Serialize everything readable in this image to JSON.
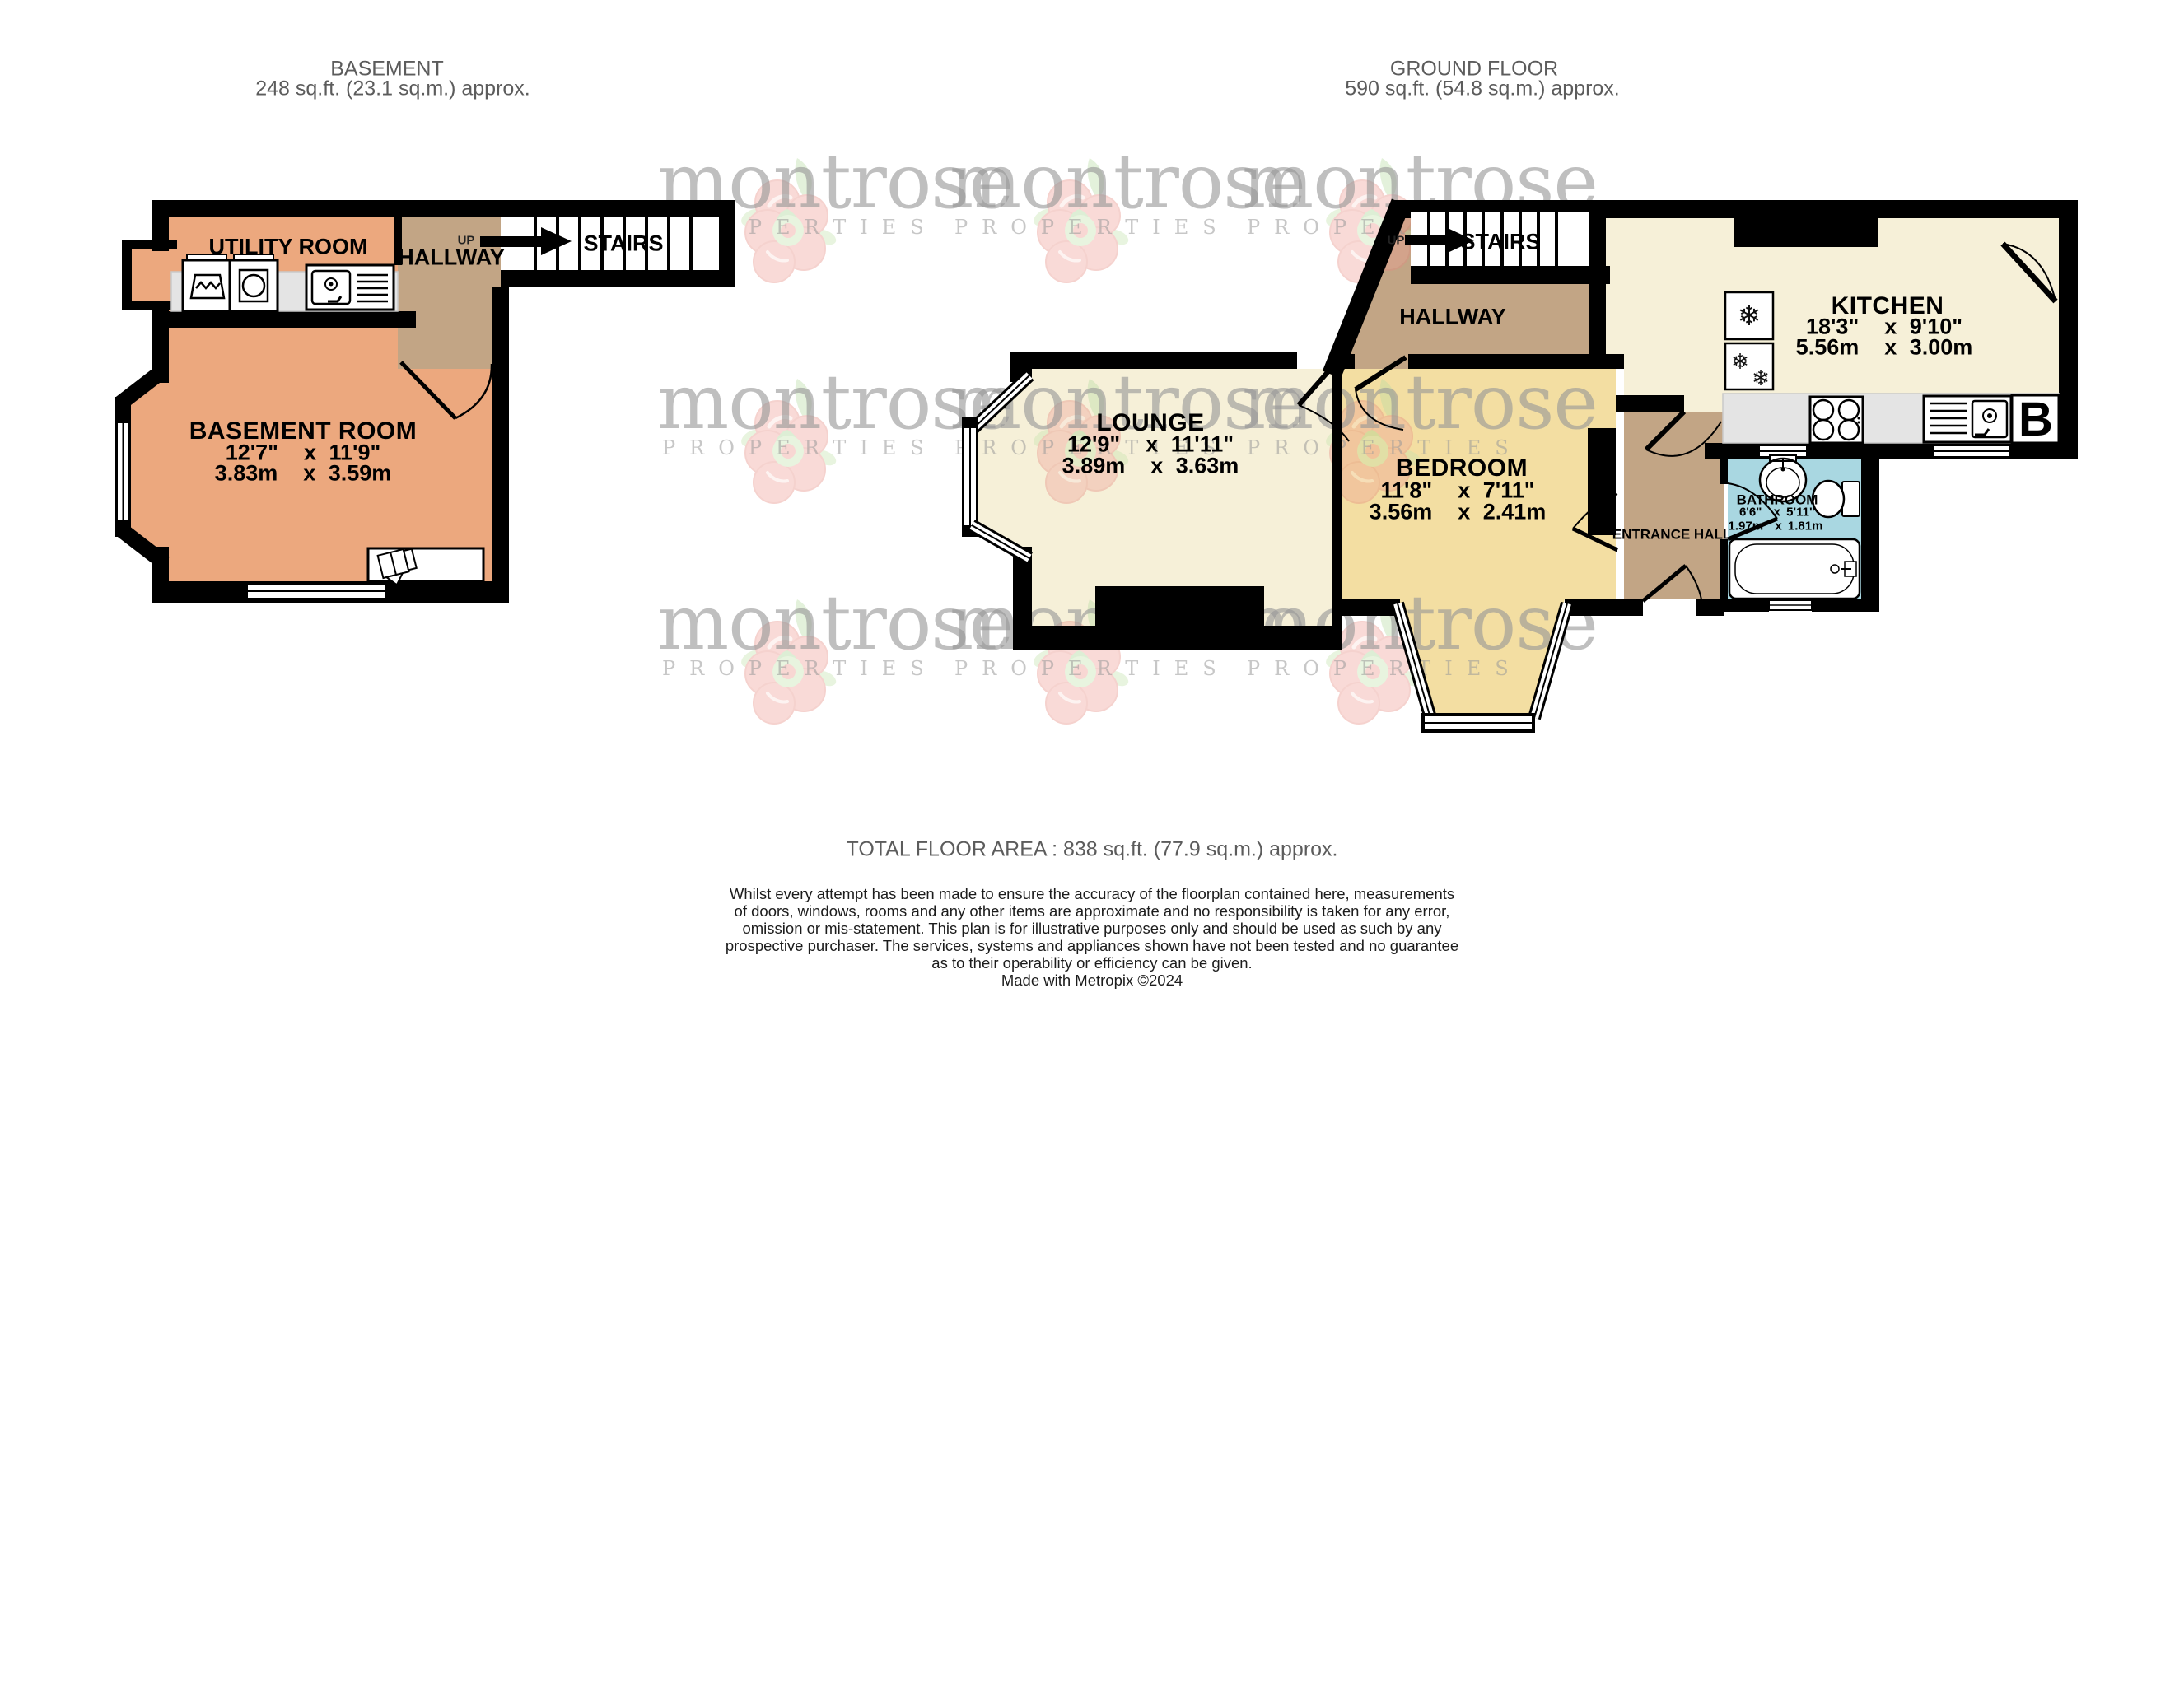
{
  "watermark": {
    "name": "montrose",
    "sub": "PROPERTIES"
  },
  "icons": {
    "snowflake": "❄"
  },
  "plans": {
    "basement": {
      "title": "BASEMENT",
      "area": "248 sq.ft. (23.1 sq.m.) approx.",
      "rooms": {
        "utility": {
          "name": "UTILITY ROOM"
        },
        "hallway": {
          "name": "HALLWAY",
          "up": "UP"
        },
        "stairs": {
          "name": "STAIRS"
        },
        "basement_room": {
          "name": "BASEMENT ROOM",
          "imperial": "12'7\"  x 11'9\"",
          "metric": "3.83m  x 3.59m"
        }
      }
    },
    "ground": {
      "title": "GROUND FLOOR",
      "area": "590 sq.ft. (54.8 sq.m.) approx.",
      "rooms": {
        "stairs": {
          "name": "STAIRS",
          "up": "UP"
        },
        "hallway": {
          "name": "HALLWAY"
        },
        "kitchen": {
          "name": "KITCHEN",
          "imperial": "18'3\"  x 9'10\"",
          "metric": "5.56m  x 3.00m"
        },
        "lounge": {
          "name": "LOUNGE",
          "imperial": "12'9\"  x 11'11\"",
          "metric": "3.89m  x 3.63m"
        },
        "bedroom": {
          "name": "BEDROOM",
          "imperial": "11'8\"  x 7'11\"",
          "metric": "3.56m  x 2.41m"
        },
        "entrance": {
          "name": "ENTRANCE HALL"
        },
        "bathroom": {
          "name": "BATHROOM",
          "imperial": "6'6\"  x 5'11\"",
          "metric": "1.97m  x 1.81m"
        },
        "boiler": {
          "label": "B"
        }
      }
    }
  },
  "footer": {
    "total": "TOTAL FLOOR AREA : 838 sq.ft. (77.9 sq.m.) approx.",
    "disclaimer_lines": [
      "Whilst every attempt has been made to ensure the accuracy of the floorplan contained here, measurements",
      "of doors, windows, rooms and any other items are approximate and no responsibility is taken for any error,",
      "omission or mis-statement. This plan is for illustrative purposes only and should be used as such by any",
      "prospective purchaser. The services, systems and appliances shown have not been tested and no guarantee",
      "as to their operability or efficiency can be given."
    ],
    "credit": "Made with Metropix ©2024"
  },
  "colors": {
    "basement_fill": "#ECA87E",
    "hall_fill": "#C2A585",
    "cream_fill": "#F6F0D8",
    "bedroom_fill": "#F3DEA2",
    "bathroom_fill": "#A9D7E1",
    "counter_fill": "#E4E4E4",
    "wall": "#000000"
  }
}
